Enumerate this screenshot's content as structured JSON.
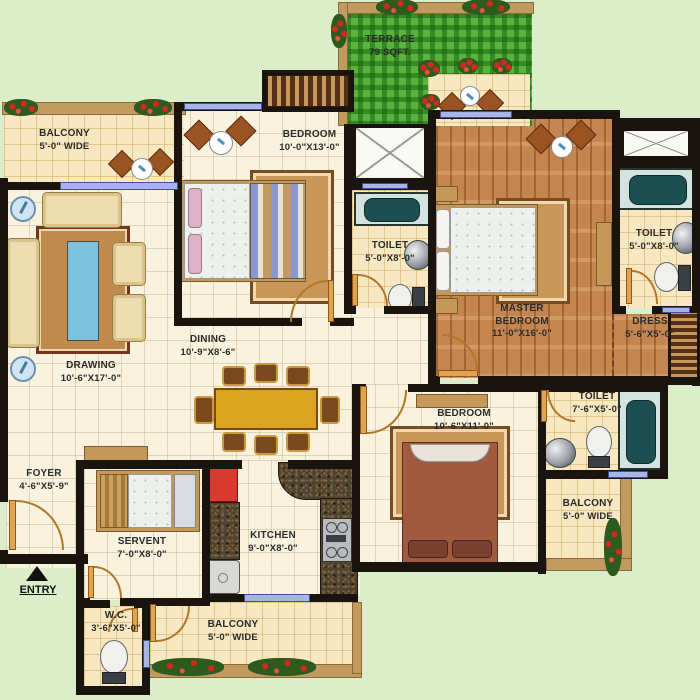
{
  "rooms": {
    "balcony_tl": {
      "name": "BALCONY",
      "dim": "5'-0\" WIDE"
    },
    "bedroom_top": {
      "name": "BEDROOM",
      "dim": "10'-0\"X13'-0\""
    },
    "terrace": {
      "name": "TERRACE",
      "dim": "79 SQFT."
    },
    "drawing": {
      "name": "DRAWING",
      "dim": "10'-6\"X17'-0\""
    },
    "dining": {
      "name": "DINING",
      "dim": "10'-9\"X8'-6\""
    },
    "toilet_mid": {
      "name": "TOILET",
      "dim": "5'-0\"X8'-0\""
    },
    "master_bedroom": {
      "name": "MASTER BEDROOM",
      "dim": "11'-0\"X16'-0\""
    },
    "toilet_right": {
      "name": "TOILET",
      "dim": "5'-0\"X8'-0\""
    },
    "dress": {
      "name": "DRESS",
      "dim": "5'-6\"X5'-0\""
    },
    "bedroom_bottom": {
      "name": "BEDROOM",
      "dim": "10'-6\"X11'-0\""
    },
    "toilet_br": {
      "name": "TOILET",
      "dim": "7'-6\"X5'-0\""
    },
    "balcony_br": {
      "name": "BALCONY",
      "dim": "5'-0\" WIDE"
    },
    "foyer": {
      "name": "FOYER",
      "dim": "4'-6\"X5'-9\""
    },
    "servant": {
      "name": "SERVENT",
      "dim": "7'-0\"X8'-0\""
    },
    "kitchen": {
      "name": "KITCHEN",
      "dim": "9'-0\"X8'-0\""
    },
    "wc": {
      "name": "W.C.",
      "dim": "3'-6\"X5'-0\""
    },
    "balcony_bottom": {
      "name": "BALCONY",
      "dim": "5'-0\" WIDE"
    }
  },
  "entry": {
    "label": "ENTRY"
  },
  "colors": {
    "background": "#dcedca",
    "wall": "#1a140e",
    "tile_floor": "#f8f2df",
    "balcony_floor": "#f7e8c2",
    "wood_floor": "#c5854f",
    "terrace_grass": "#58b43c",
    "window_blue": "#a8b4e6",
    "door_tan": "#e2a44c",
    "bathtub_teal": "#1d4f52",
    "dining_table": "#d9a521",
    "fridge_red": "#d93a2e",
    "flower_red": "#d42a1e"
  }
}
